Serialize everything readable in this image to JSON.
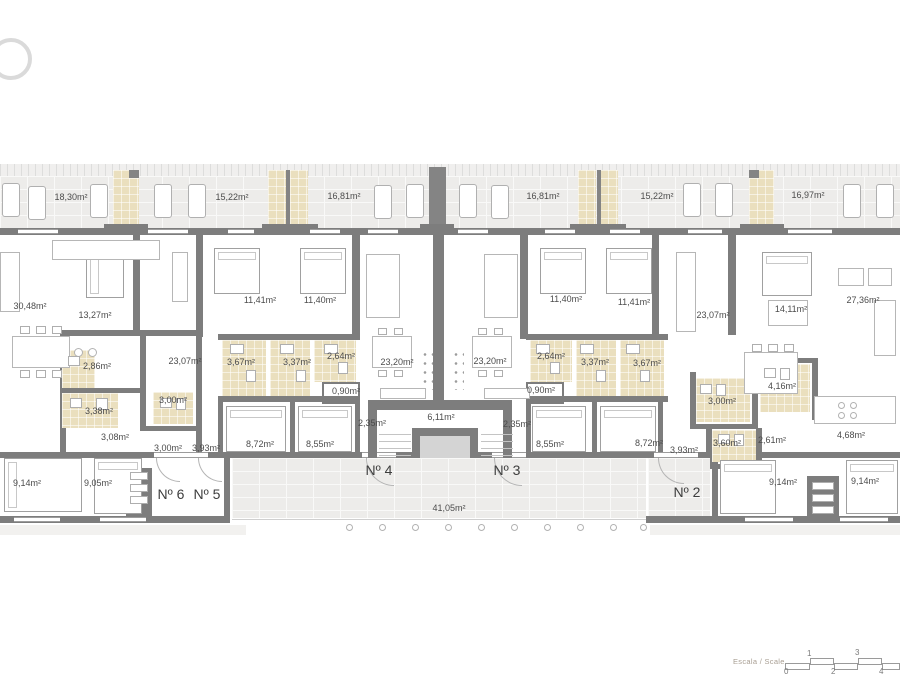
{
  "plan": {
    "terrace_areas": [
      "18,30m²",
      "15,22m²",
      "16,81m²",
      "16,81m²",
      "15,22m²",
      "16,97m²"
    ],
    "rooms": {
      "living_left": "30,48m²",
      "bed_1327": "13,27m²",
      "bed_1141_a": "11,41m²",
      "bed_1140_a": "11,40m²",
      "kitchen_2307_a": "23,07m²",
      "bath_367_a": "3,67m²",
      "bath_337_a": "3,37m²",
      "bath_264_a": "2,64m²",
      "closet_090_a": "0,90m²",
      "living_2320_a": "23,20m²",
      "living_2320_b": "23,20m²",
      "bath_264_b": "2,64m²",
      "bath_337_b": "3,37m²",
      "bath_367_b": "3,67m²",
      "closet_090_b": "0,90m²",
      "bed_1140_b": "11,40m²",
      "bed_1141_b": "11,41m²",
      "kitchen_2307_b": "23,07m²",
      "bed_1411": "14,11m²",
      "living_right": "27,36m²",
      "bath_286": "2,86m²",
      "bath_338": "3,38m²",
      "util_300_a": "3,00m²",
      "hall_308": "3,08m²",
      "util_300_b": "3,00m²",
      "hall_393_a": "3,93m²",
      "bed_872_a": "8,72m²",
      "bed_855_a": "8,55m²",
      "hall_235_a": "2,35m²",
      "stairwell": "6,11m²",
      "hall_235_b": "2,35m²",
      "bed_855_b": "8,55m²",
      "bed_872_b": "8,72m²",
      "hall_393_b": "3,93m²",
      "bath_360": "3,60m²",
      "hall_261": "2,61m²",
      "bath_300_c": "3,00m²",
      "bath_416": "4,16m²",
      "kitchen_468": "4,68m²",
      "bed_914_a": "9,14m²",
      "bed_905": "9,05m²",
      "bed_914_b": "9,14m²",
      "bed_914_c": "9,14m²",
      "terrace_communal": "41,05m²"
    },
    "unit_labels": {
      "n6": "Nº 6",
      "n5": "Nº 5",
      "n4": "Nº 4",
      "n3": "Nº 3",
      "n2": "Nº 2"
    }
  },
  "scale_bar": {
    "label": "Escala / Scale",
    "ticks_above": [
      "1",
      "3"
    ],
    "ticks_below": [
      "0",
      "2",
      "4"
    ]
  },
  "icons": {
    "logo": "ring-logo"
  },
  "colors": {
    "wall": "#7d7d7d",
    "bathroom_floor": "#eadfbe",
    "terrace_tile": "#edecea",
    "background": "#ffffff",
    "label_text": "#4c4c4c"
  }
}
